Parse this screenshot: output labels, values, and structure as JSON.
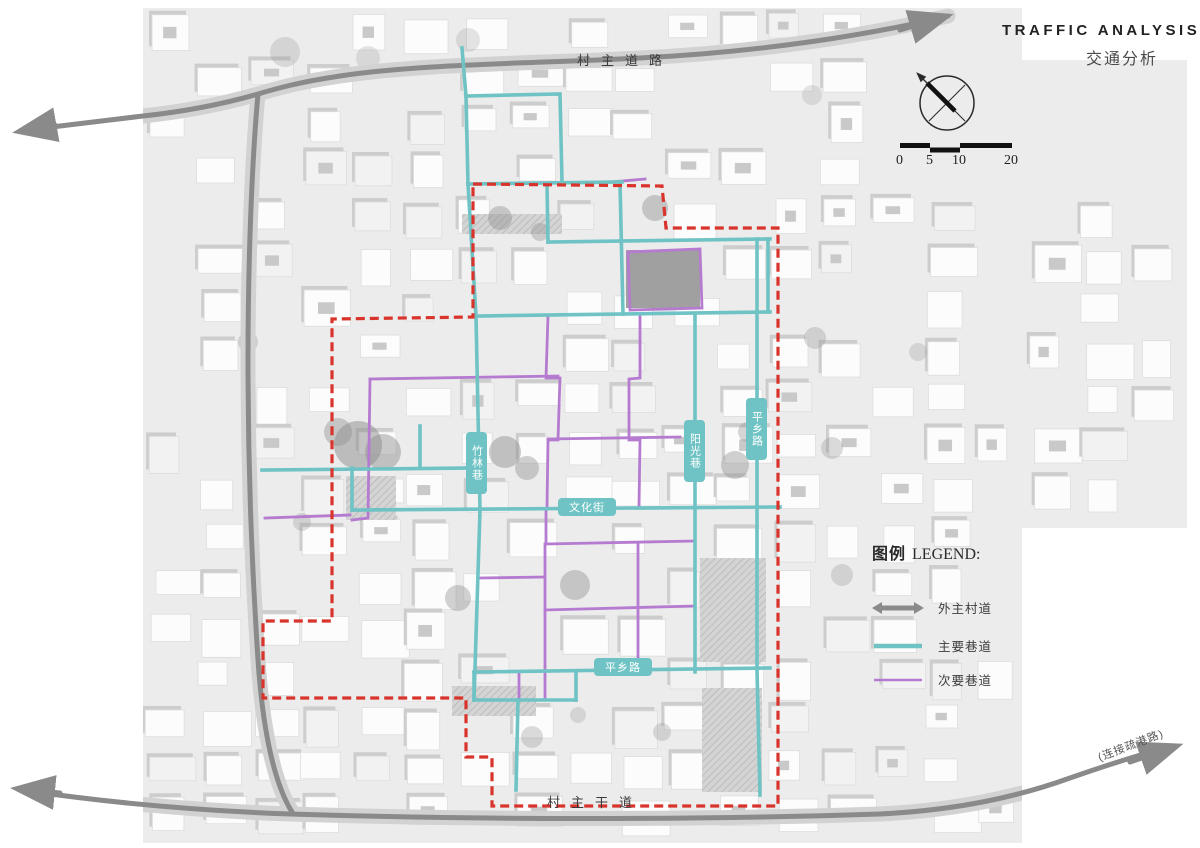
{
  "title": {
    "en": "TRAFFIC ANALYSIS",
    "zh": "交通分析"
  },
  "scale_bar": {
    "labels": [
      "0",
      "5",
      "10",
      "20"
    ]
  },
  "compass": {
    "icon": "north-compass"
  },
  "legend": {
    "title_zh": "图例",
    "title_en": "LEGEND:",
    "items": [
      {
        "label": "外主村道",
        "swatch": "gray-double-arrow"
      },
      {
        "label": "主要巷道",
        "swatch": "teal-line"
      },
      {
        "label": "次要巷道",
        "swatch": "purple-line"
      }
    ]
  },
  "roads": {
    "top_label": "村主道路",
    "bottom_label": "村主干道",
    "connector_label": "(连接疏港路)"
  },
  "streets": {
    "zhulin": "竹林巷",
    "yangguang": "阳光巷",
    "wenhua": "文化街",
    "pingxiang_bottom": "平乡路",
    "pingxiang_right": "平乡路"
  },
  "colors": {
    "main_lane": "#6fc3c4",
    "secondary_lane": "#b57bd0",
    "site_boundary": "#d9342b",
    "village_road": "#8a8a8a",
    "road_band": "#d2d2d2",
    "map_background": "#ececec"
  }
}
